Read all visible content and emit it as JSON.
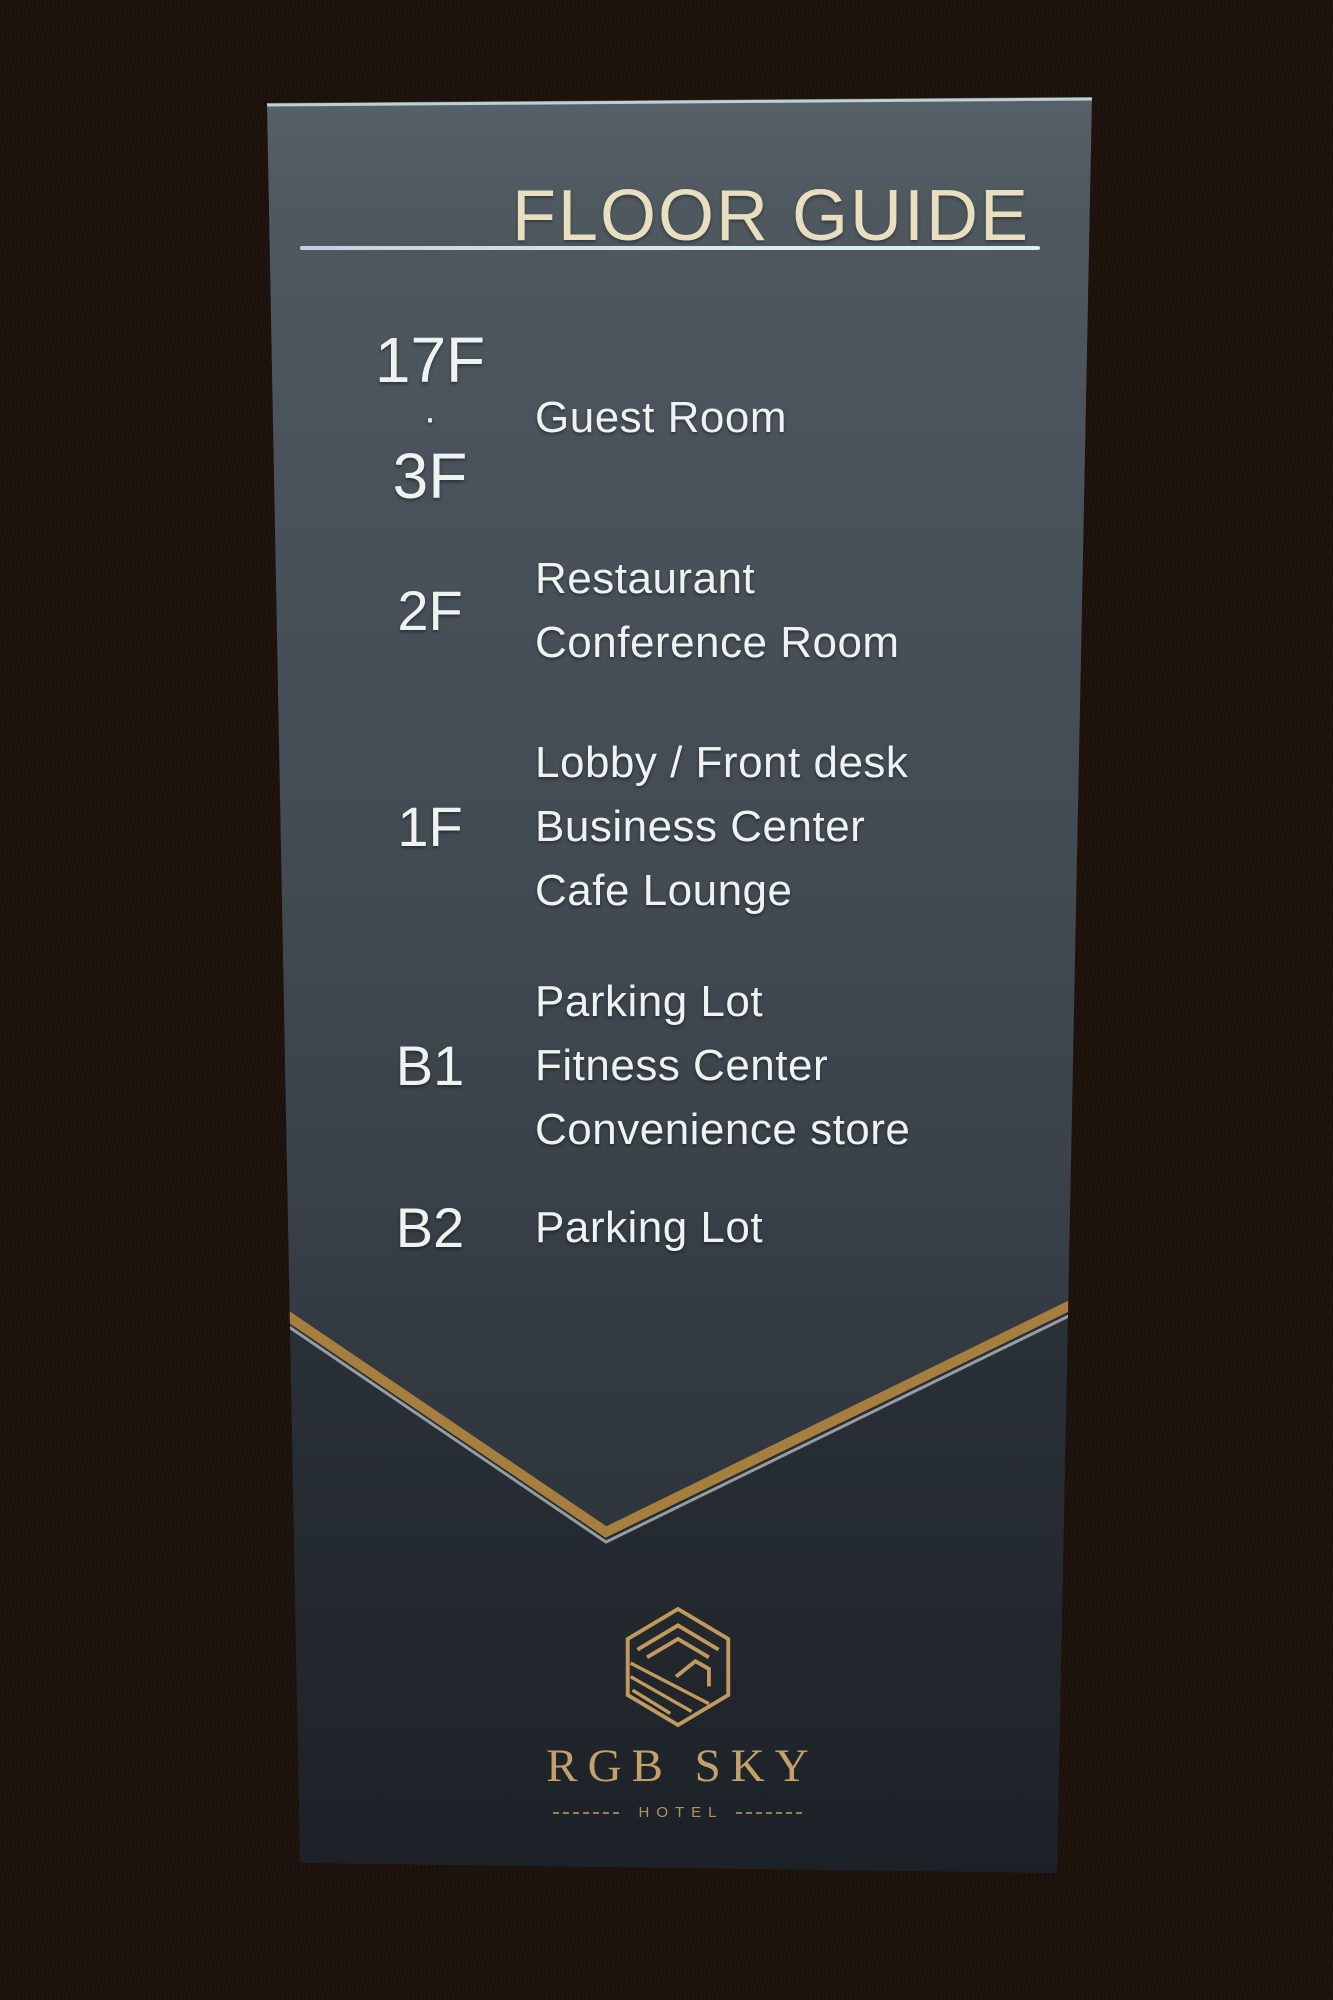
{
  "sign": {
    "title": "FLOOR GUIDE",
    "floors": [
      {
        "floor_lines": [
          "17F",
          "·",
          "3F"
        ],
        "labels": [
          "Guest Room"
        ]
      },
      {
        "floor_lines": [
          "2F"
        ],
        "labels": [
          "Restaurant",
          "Conference Room"
        ]
      },
      {
        "floor_lines": [
          "1F"
        ],
        "labels": [
          "Lobby / Front desk",
          "Business Center",
          "Cafe Lounge"
        ]
      },
      {
        "floor_lines": [
          "B1"
        ],
        "labels": [
          "Parking Lot",
          "Fitness Center",
          "Convenience store"
        ]
      },
      {
        "floor_lines": [
          "B2"
        ],
        "labels": [
          "Parking Lot"
        ]
      }
    ],
    "brand": {
      "name": "RGB SKY",
      "tagline": "HOTEL"
    },
    "colors": {
      "panel_upper": "#49525a",
      "panel_lower": "#232930",
      "title_text": "#e8dfc0",
      "floor_text": "#eef2f1",
      "divider_line": "#d6e6ea",
      "chevron_gold": "#a67f3e",
      "brand_gold": "#c29a5e",
      "wall_light": "#f1ece5",
      "wall_dark": "#1c100a"
    }
  }
}
